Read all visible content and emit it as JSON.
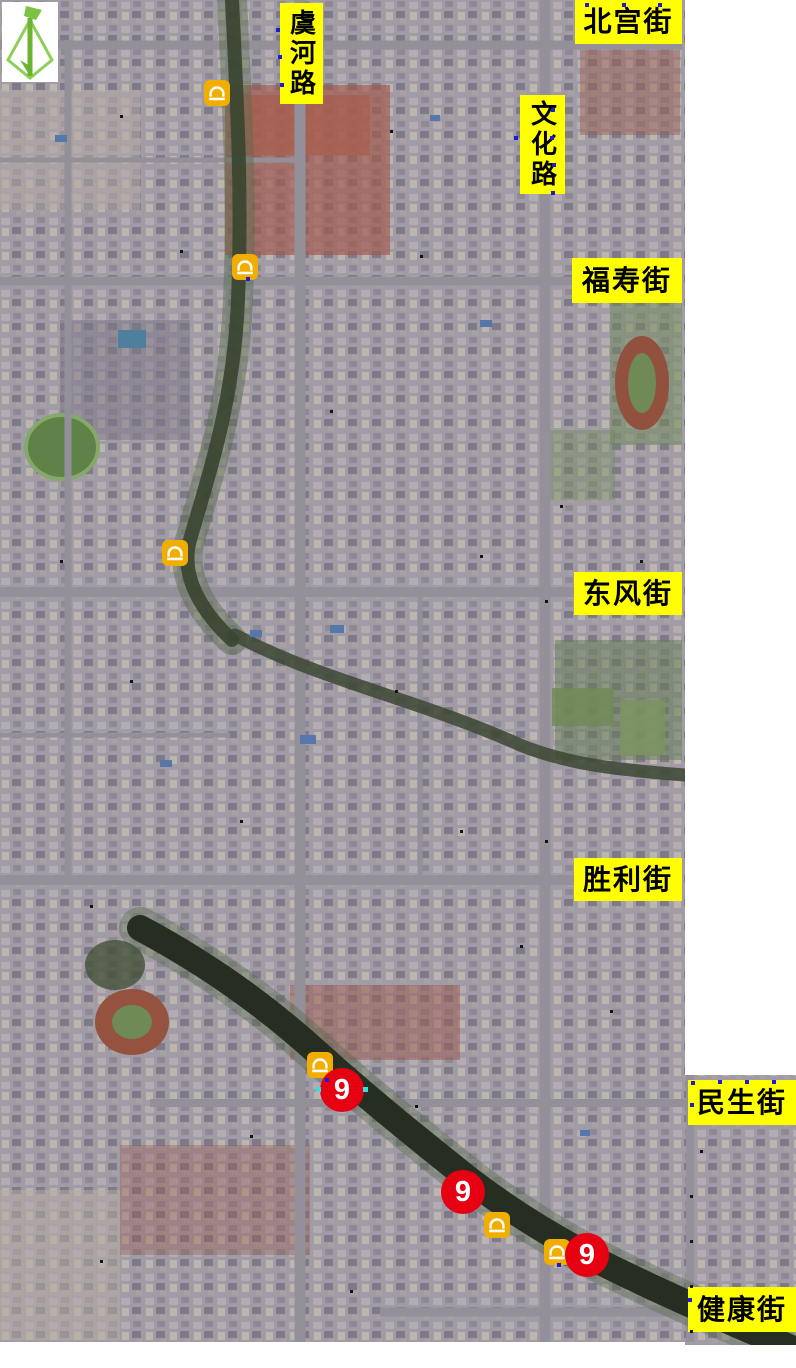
{
  "map": {
    "compass": {
      "name": "north-arrow"
    },
    "street_labels": [
      {
        "id": "beigong",
        "text": "北宫街",
        "orientation": "horizontal",
        "x": 575,
        "y": 0,
        "w": 107,
        "h": 44
      },
      {
        "id": "yuhe",
        "text": "虞河路",
        "orientation": "vertical",
        "x": 280,
        "y": 3,
        "w": 43,
        "h": 101
      },
      {
        "id": "wenhua",
        "text": "文化路",
        "orientation": "vertical",
        "x": 520,
        "y": 95,
        "w": 45,
        "h": 99
      },
      {
        "id": "fushou",
        "text": "福寿街",
        "orientation": "horizontal",
        "x": 572,
        "y": 258,
        "w": 110,
        "h": 45
      },
      {
        "id": "dongfeng",
        "text": "东风街",
        "orientation": "horizontal",
        "x": 574,
        "y": 572,
        "w": 108,
        "h": 43
      },
      {
        "id": "shengli",
        "text": "胜利街",
        "orientation": "horizontal",
        "x": 574,
        "y": 858,
        "w": 108,
        "h": 43
      },
      {
        "id": "minsheng",
        "text": "民生街",
        "orientation": "horizontal",
        "x": 688,
        "y": 1080,
        "w": 108,
        "h": 45
      },
      {
        "id": "jiankang",
        "text": "健康街",
        "orientation": "horizontal",
        "x": 688,
        "y": 1287,
        "w": 108,
        "h": 45
      }
    ],
    "bridge_icons": [
      {
        "x": 204,
        "y": 80
      },
      {
        "x": 232,
        "y": 254
      },
      {
        "x": 162,
        "y": 540
      },
      {
        "x": 307,
        "y": 1052
      },
      {
        "x": 484,
        "y": 1212
      },
      {
        "x": 544,
        "y": 1239
      }
    ],
    "numbered_markers": [
      {
        "value": "9",
        "x": 342,
        "y": 1090,
        "handles": true
      },
      {
        "value": "9",
        "x": 463,
        "y": 1192,
        "handles": false
      },
      {
        "value": "9",
        "x": 587,
        "y": 1255,
        "handles": false
      }
    ],
    "colors": {
      "label_bg": "#ffff00",
      "label_text": "#000000",
      "marker_red": "#e60012",
      "marker_text": "#ffffff",
      "bridge_yellow": "#f2ae00",
      "compass_green": "#7dc242",
      "vertex_blue": "#1c1cd6",
      "vertex_black": "#141414"
    },
    "vertex_dots_blue": [
      [
        585,
        3
      ],
      [
        622,
        3
      ],
      [
        658,
        3
      ],
      [
        276,
        28
      ],
      [
        278,
        55
      ],
      [
        280,
        83
      ],
      [
        551,
        108
      ],
      [
        514,
        136
      ],
      [
        550,
        136
      ],
      [
        552,
        163
      ],
      [
        551,
        191
      ],
      [
        246,
        277
      ],
      [
        691,
        1081
      ],
      [
        718,
        1080
      ],
      [
        745,
        1080
      ],
      [
        772,
        1080
      ],
      [
        690,
        1103
      ],
      [
        688,
        1298
      ],
      [
        557,
        1263
      ],
      [
        325,
        1078
      ]
    ],
    "vertex_dots_black": [
      [
        120,
        115
      ],
      [
        390,
        130
      ],
      [
        180,
        250
      ],
      [
        420,
        255
      ],
      [
        330,
        410
      ],
      [
        60,
        560
      ],
      [
        480,
        555
      ],
      [
        130,
        680
      ],
      [
        395,
        690
      ],
      [
        560,
        505
      ],
      [
        640,
        560
      ],
      [
        240,
        820
      ],
      [
        460,
        830
      ],
      [
        90,
        905
      ],
      [
        520,
        945
      ],
      [
        610,
        1010
      ],
      [
        700,
        1150
      ],
      [
        690,
        1195
      ],
      [
        690,
        1240
      ],
      [
        690,
        1285
      ],
      [
        690,
        1330
      ],
      [
        250,
        1135
      ],
      [
        100,
        1260
      ],
      [
        350,
        1290
      ],
      [
        545,
        600
      ],
      [
        545,
        840
      ],
      [
        415,
        1105
      ]
    ]
  }
}
